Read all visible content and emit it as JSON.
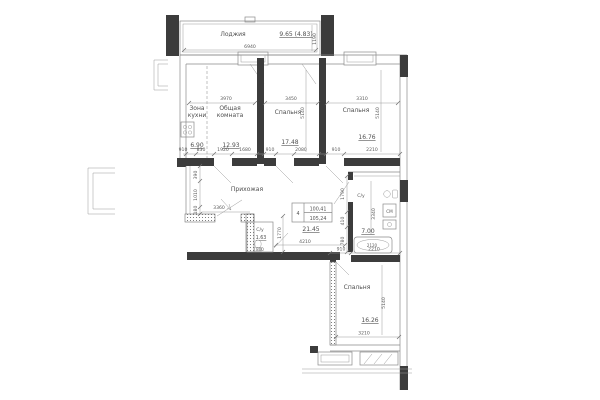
{
  "colors": {
    "background": "#ffffff",
    "walls": "#3c3c3c",
    "lines": "#8a8a8a",
    "text": "#4f4f4f"
  },
  "loggia": {
    "label": "Лоджия",
    "area": "9.65 (4.83)",
    "width_dim": "6940",
    "depth_dim": "1190"
  },
  "kitchen_zone": {
    "label_line1": "Зона",
    "label_line2": "кухни",
    "area": "6.90"
  },
  "living_room": {
    "label_line1": "Общая",
    "label_line2": "комната",
    "area": "12.93",
    "width_dim": "3970"
  },
  "bedroom_middle": {
    "label": "Спальня",
    "area": "17.48",
    "width_dim": "3450",
    "depth_dim": "5140",
    "door_dim": "910",
    "pier_dim": "2080"
  },
  "bedroom_right": {
    "label": "Спальня",
    "area": "16.76",
    "width_dim": "3310",
    "depth_dim": "5140",
    "door_dim": "910",
    "pier_dim": "2210"
  },
  "bedroom_bottom": {
    "label": "Спальня",
    "area": "16.26",
    "width_dim": "3210",
    "depth_dim": "5140",
    "door_dim": "910",
    "pier_dim": "2210"
  },
  "hallway": {
    "label": "Прихожая",
    "area": "21.45",
    "entry_dim": "3360",
    "width_dim": "4210"
  },
  "wc": {
    "label": "С/у",
    "area": "1.63",
    "width_dim": "800",
    "depth_dim": "1770"
  },
  "bathroom": {
    "label": "С/у",
    "area": "7.00",
    "depth_dim": "3340",
    "tub_dim": "2120",
    "washer_label": "СМ"
  },
  "stamp": {
    "flat_number": "4",
    "area_living": "100,41",
    "area_total": "105,24"
  },
  "dim_chains": {
    "upper_wall": [
      "910",
      "830",
      "1920",
      "1680"
    ],
    "hall_left": [
      "390",
      "1010",
      "180"
    ],
    "corridor_right": [
      "1790",
      "410",
      "780"
    ]
  }
}
